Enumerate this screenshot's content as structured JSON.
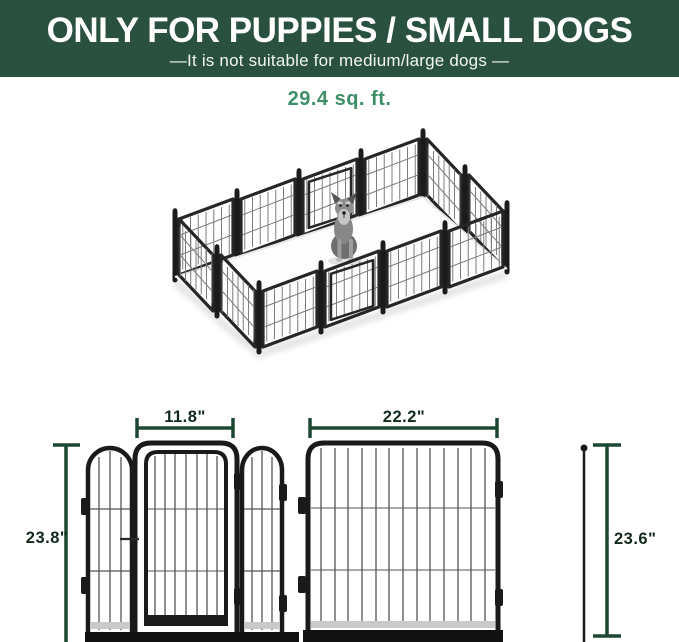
{
  "banner": {
    "title": "ONLY FOR PUPPIES / SMALL DOGS",
    "subtitle": "—It is not suitable for medium/large dogs —",
    "bg_color": "#2a5140",
    "text_color": "#ffffff"
  },
  "area_label": {
    "text": "29.4 sq. ft.",
    "color": "#3e8e68"
  },
  "illustration": {
    "description": "12-panel black metal dog playpen shown in isometric view with a grey miniature schnauzer sitting inside",
    "panel_color": "#262626",
    "floor_color": "#fdfdfd"
  },
  "dimension_diagram": {
    "line_color": "#1d4732",
    "text_color": "#13291c",
    "door_section": {
      "width_label": "11.8\"",
      "height_label": "23.8\""
    },
    "panel_section": {
      "width_label": "22.2\"",
      "height_label": "23.6\""
    }
  }
}
